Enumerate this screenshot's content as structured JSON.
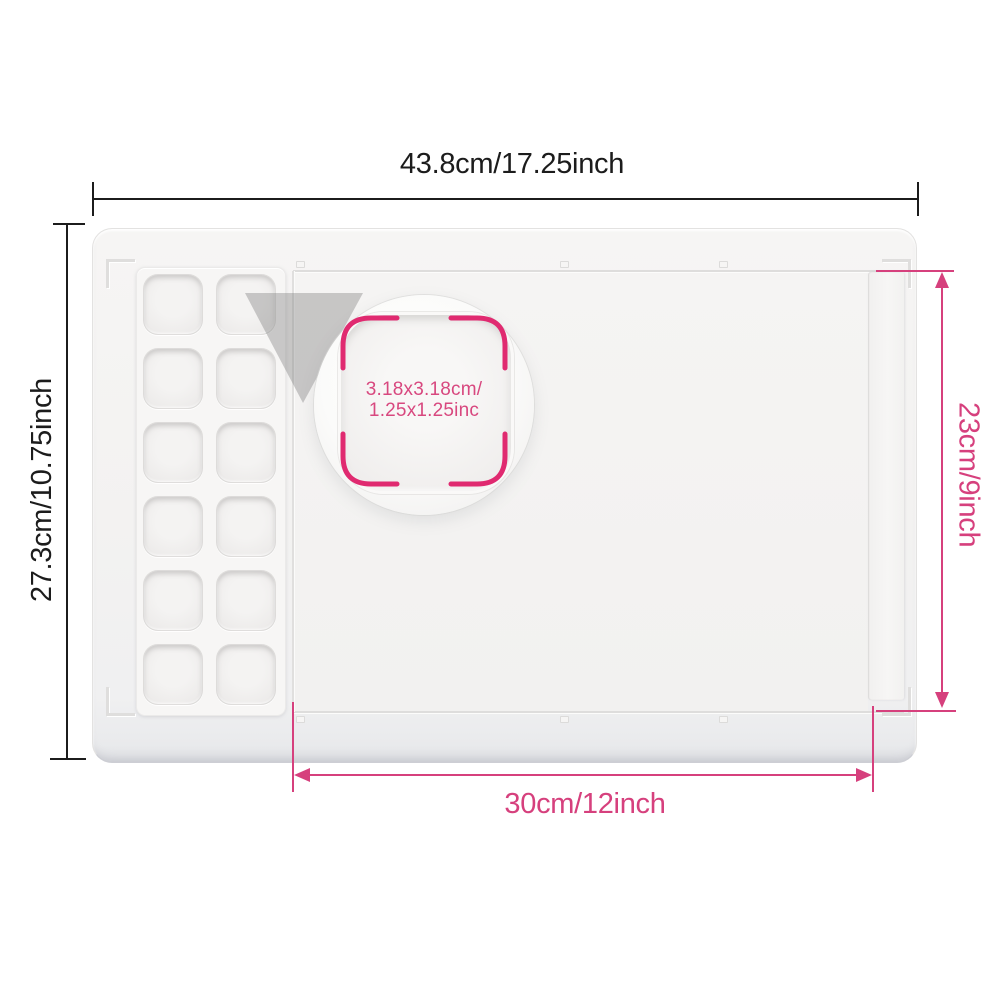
{
  "colors": {
    "accent_pink": "#d6407d",
    "bracket_pink": "#e02a70",
    "dimension_black": "#1c1c1c",
    "mat_surface": "#f3f2f1",
    "background": "#ffffff"
  },
  "annotations": {
    "top_width": "43.8cm/17.25inch",
    "left_height": "27.3cm/10.75inch",
    "right_inner_height": "23cm/9inch",
    "bottom_inner_width": "30cm/12inch",
    "well_size_line1": "3.18x3.18cm/",
    "well_size_line2": "1.25x1.25inc"
  },
  "palette": {
    "rows": 6,
    "columns": 2,
    "well_count": 12
  }
}
